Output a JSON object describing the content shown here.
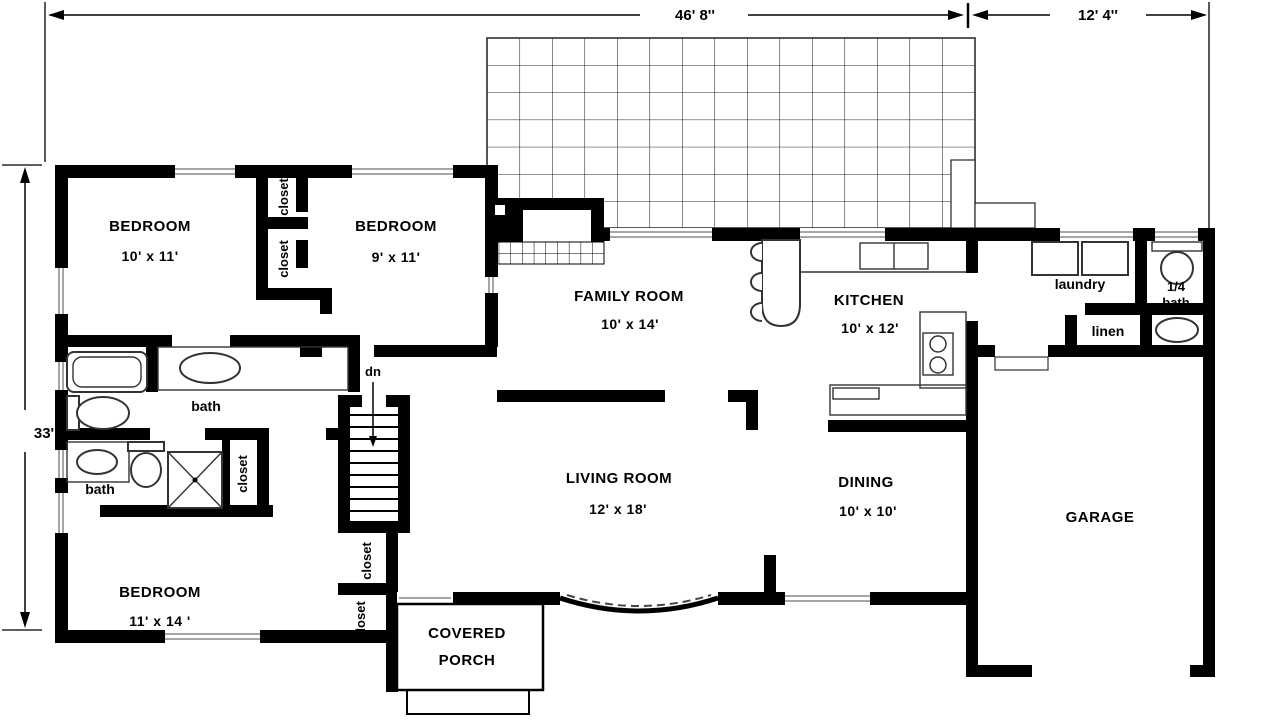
{
  "dimensions": {
    "width_main": "46' 8''",
    "width_garage": "12' 4''",
    "height_left": "33'"
  },
  "rooms": {
    "bedroom_top_left": {
      "name": "BEDROOM",
      "size": "10' x 11'"
    },
    "bedroom_top_mid": {
      "name": "BEDROOM",
      "size": "9' x 11'"
    },
    "bedroom_bottom": {
      "name": "BEDROOM",
      "size": "11' x 14 '"
    },
    "family_room": {
      "name": "FAMILY ROOM",
      "size": "10' x 14'"
    },
    "kitchen": {
      "name": "KITCHEN",
      "size": "10' x 12'"
    },
    "living_room": {
      "name": "LIVING ROOM",
      "size": "12' x 18'"
    },
    "dining": {
      "name": "DINING",
      "size": "10' x 10'"
    },
    "garage": {
      "name": "GARAGE"
    },
    "laundry": {
      "name": "laundry"
    },
    "quarter_bath": {
      "line1": "1/4",
      "line2": "bath"
    },
    "linen": {
      "name": "linen"
    },
    "bath_hall": {
      "name": "bath"
    },
    "bath_lower": {
      "name": "bath"
    },
    "covered_porch": {
      "line1": "COVERED",
      "line2": "PORCH"
    }
  },
  "labels": {
    "closet": "closet",
    "stairs_down": "dn"
  },
  "colors": {
    "wall": "#000000",
    "background": "#ffffff",
    "fixture_line": "#333333",
    "window_line": "#888888"
  }
}
